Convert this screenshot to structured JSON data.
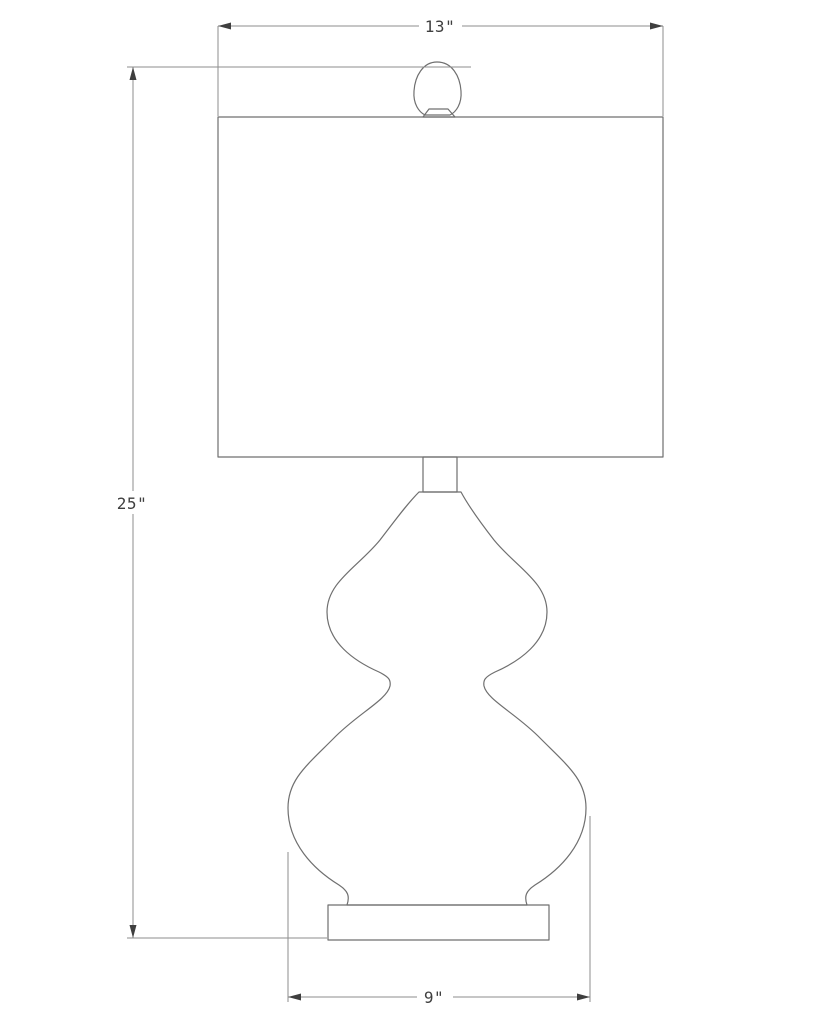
{
  "drawing": {
    "name": "Table lamp technical dimension drawing",
    "type": "line-drawing",
    "dimensions": {
      "shade_width": "13\"",
      "overall_height": "25\"",
      "base_width": "9\""
    },
    "colors": {
      "background": "#ffffff",
      "object_line": "#6f6f6f",
      "dimension_line": "#8e8e8e",
      "label_text": "#3f3f3f"
    }
  }
}
